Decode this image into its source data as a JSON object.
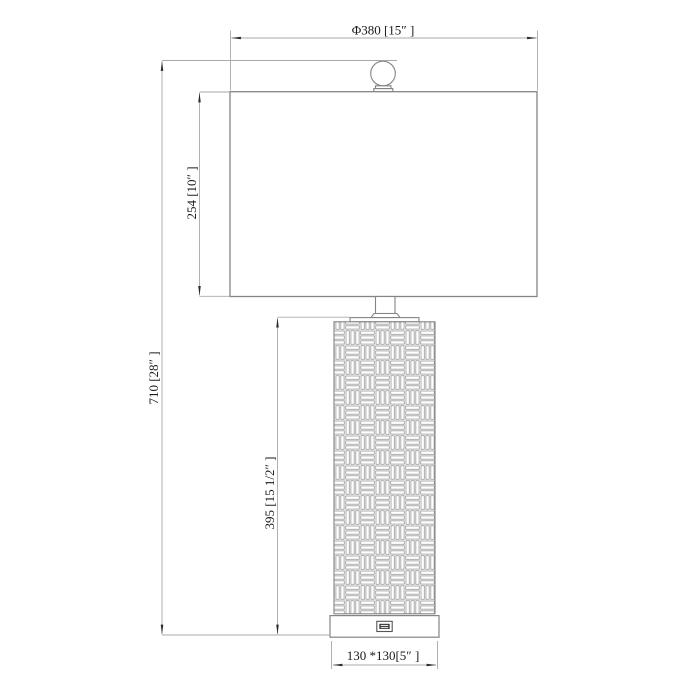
{
  "drawing": {
    "title": "table-lamp-dimension-drawing",
    "labels": {
      "shade_width": "Φ380 [15″ ]",
      "shade_height": "254 [10″ ]",
      "total_height": "710 [28″ ]",
      "body_height": "395 [15 1/2″ ]",
      "base_size": "130 *130[5″ ]"
    },
    "colors": {
      "outline": "#848484",
      "dimension_line": "#a9a9a9",
      "pattern_line": "#9a9a9a",
      "arrow": "#2a2a2a",
      "text": "#1a1a1a",
      "background": "#ffffff"
    }
  }
}
